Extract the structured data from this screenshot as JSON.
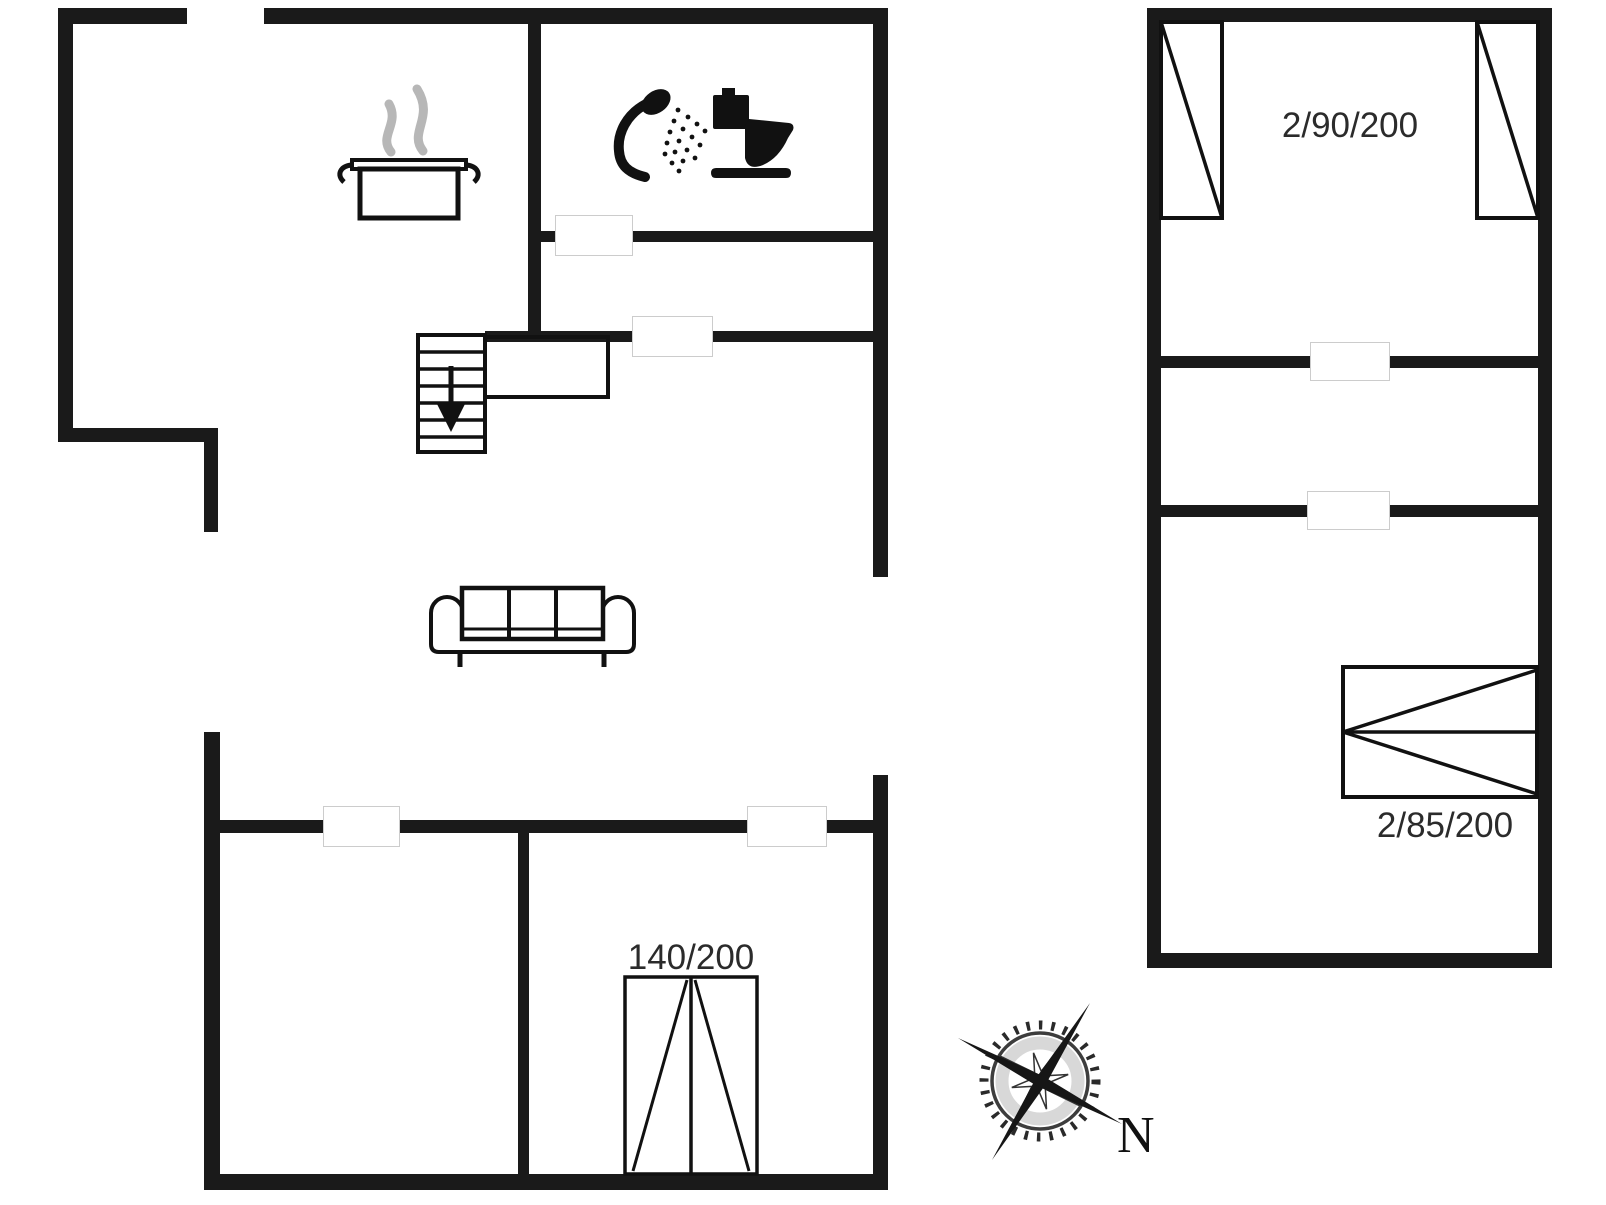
{
  "canvas": {
    "width": 1606,
    "height": 1205,
    "background": "#ffffff"
  },
  "plan": {
    "name": "holiday-house-floor-plan",
    "colors": {
      "wall": "#1a1a1a",
      "icon": "#111111",
      "steam": "#b7b7b7",
      "door_outline": "#cccccc",
      "label": "#2b2b2b"
    },
    "labels": {
      "double_bed": "140/200",
      "twin_beds": "2/90/200",
      "bunk_bed": "2/85/200",
      "compass_north": "N"
    },
    "icons": [
      "cooking-pot-icon",
      "steam-icon",
      "shower-icon",
      "toilet-icon",
      "stairs-down-icon",
      "sofa-icon",
      "single-bed-icon",
      "double-bed-icon",
      "bunk-bed-icon",
      "compass-rose-icon"
    ]
  }
}
